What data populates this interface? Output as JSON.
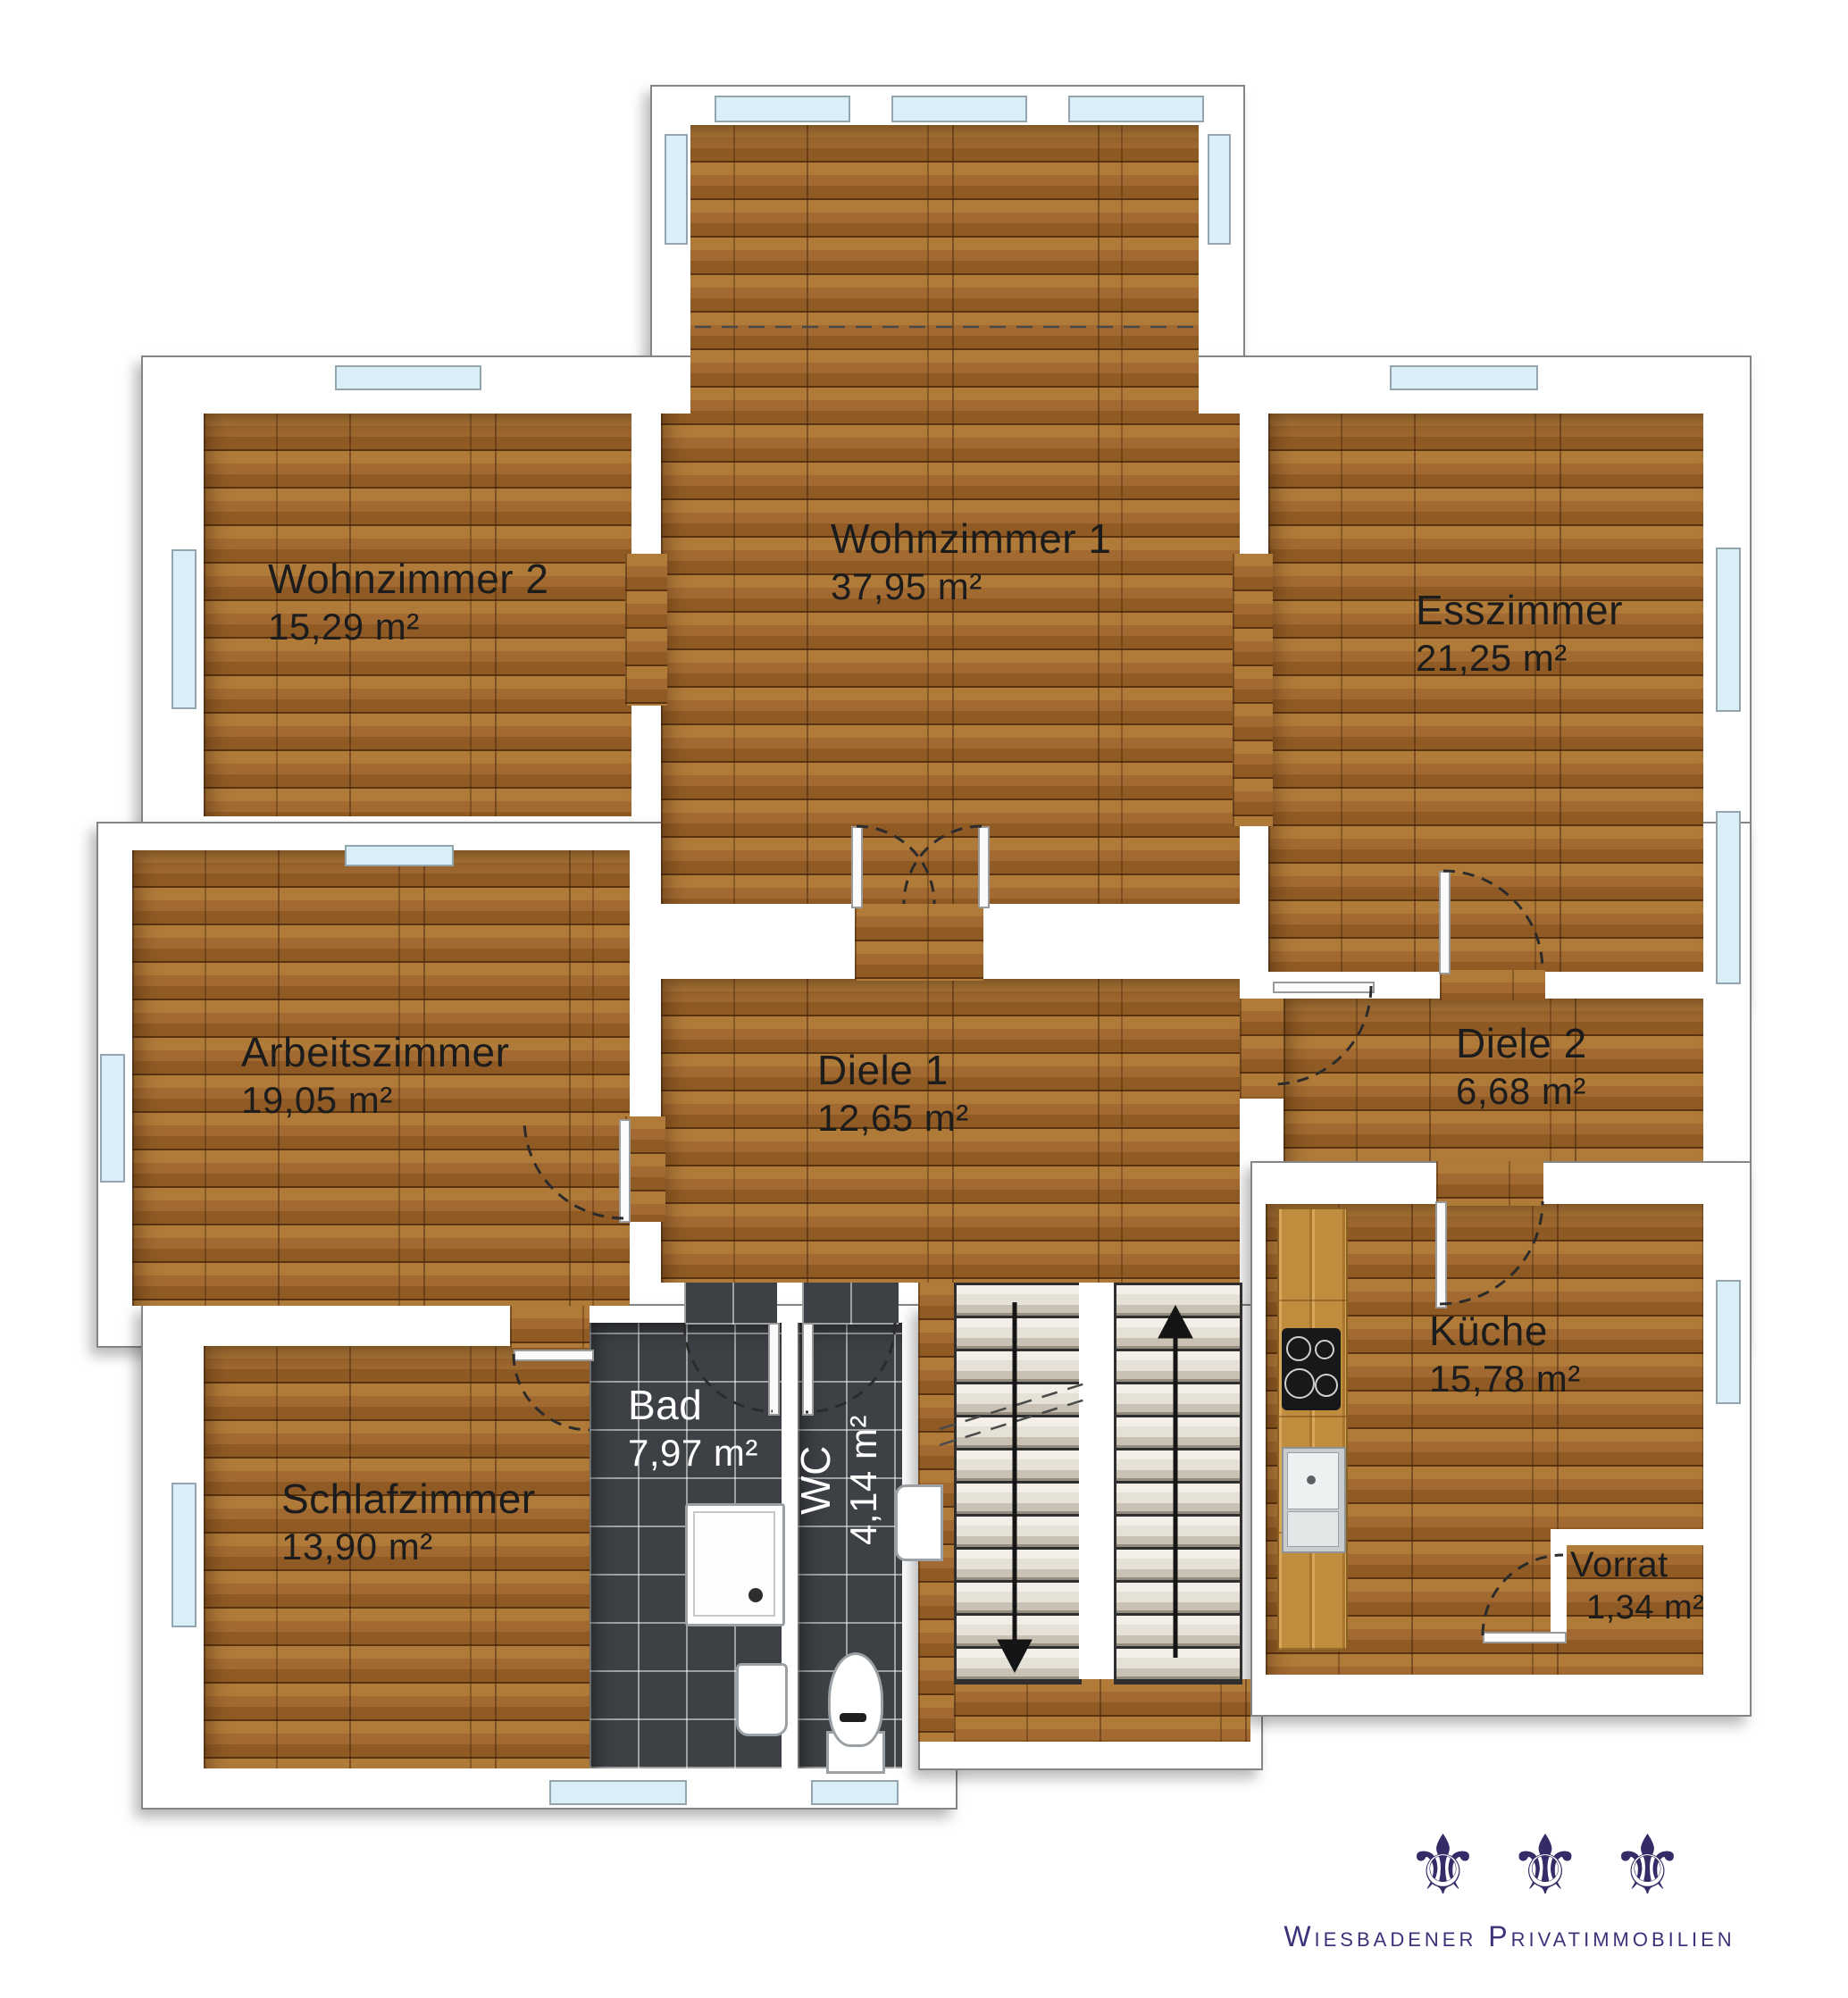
{
  "plan": {
    "rooms": {
      "wohnzimmer1": {
        "name": "Wohnzimmer 1",
        "area": "37,95 m²"
      },
      "wohnzimmer2": {
        "name": "Wohnzimmer 2",
        "area": "15,29 m²"
      },
      "esszimmer": {
        "name": "Esszimmer",
        "area": "21,25 m²"
      },
      "arbeitszimmer": {
        "name": "Arbeitszimmer",
        "area": "19,05 m²"
      },
      "diele1": {
        "name": "Diele 1",
        "area": "12,65 m²"
      },
      "diele2": {
        "name": "Diele 2",
        "area": "6,68 m²"
      },
      "schlafzimmer": {
        "name": "Schlafzimmer",
        "area": "13,90 m²"
      },
      "bad": {
        "name": "Bad",
        "area": "7,97 m²"
      },
      "wc": {
        "name": "WC",
        "area": "4,14 m²"
      },
      "kueche": {
        "name": "Küche",
        "area": "15,78 m²"
      },
      "vorrat": {
        "name": "Vorrat",
        "area": "1,34 m²"
      }
    },
    "colors": {
      "wall": "#ffffff",
      "floor_wood": "#a26a30",
      "bath_tile": "#3d4045",
      "window_glass": "#daeef7",
      "label_dark": "#1c1c1c",
      "label_light": "#ffffff",
      "logo_navy": "#332c66"
    }
  },
  "logo": {
    "brand": "Wiesbadener Privatimmobilien",
    "fleur_glyph": "⚜",
    "fleur_count": 3
  }
}
